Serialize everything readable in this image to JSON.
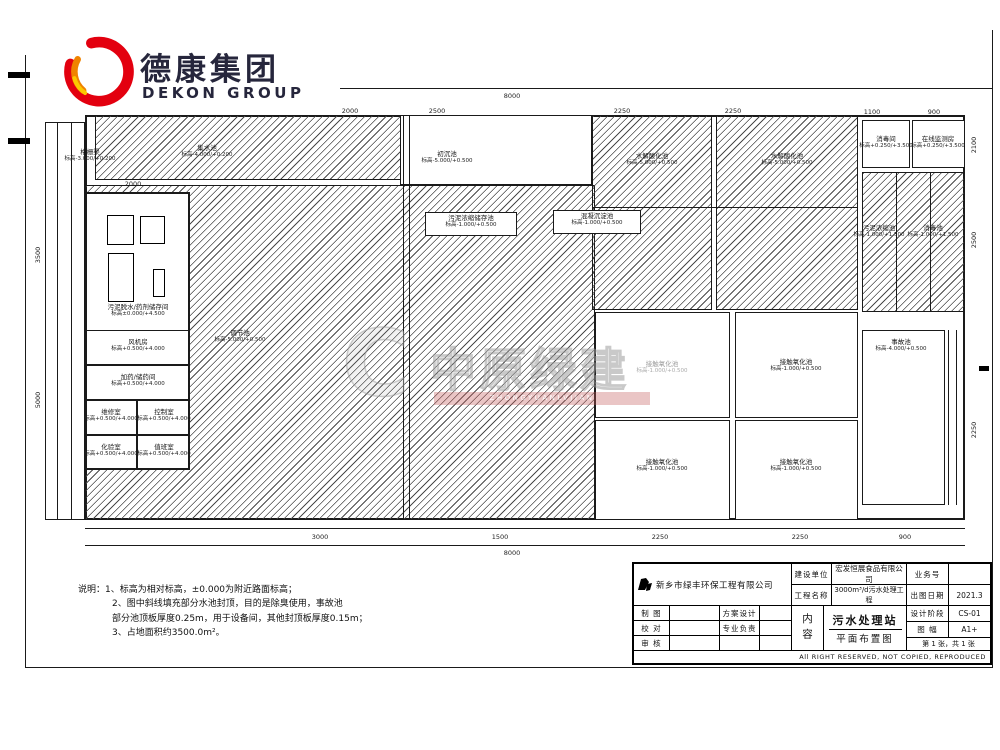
{
  "brand": {
    "logo_cn": "德康集团",
    "logo_en": "DEKON GROUP"
  },
  "watermark": {
    "mark": "C",
    "text": "中原绿建",
    "sub": "ZHONGYUANLVJIAN"
  },
  "notes": {
    "lines": [
      {
        "t": "说明：1、标高为相对标高，±0.000为附近路面标高；",
        "ind": 0
      },
      {
        "t": "2、图中斜线填充部分水池封顶，目的是除臭使用，事故池",
        "ind": 34
      },
      {
        "t": "部分池顶板厚度0.25m，用于设备间，其他封顶板厚度0.15m；",
        "ind": 34
      },
      {
        "t": "3、占地面积约3500.0m²。",
        "ind": 34
      }
    ]
  },
  "title_block": {
    "company": "新乡市绿丰环保工程有限公司",
    "jsdw_label": "建设单位",
    "jsdw_value": "宏发恒展食品有限公司",
    "gcmc_label": "工程名称",
    "gcmc_value": "3000m³/d污水处理工程",
    "ywh_label": "业务号",
    "ywh_value": "",
    "ctrq_label": "出图日期",
    "ctrq_value": "2021.3",
    "zt_label": "制 图",
    "fasj_label": "方案设计",
    "jd_label": "校 对",
    "zyfz_label": "专业负责",
    "sh_label": "审 核",
    "nr_label": "内容",
    "content_line1": "污水处理站",
    "content_line2": "平面布置图",
    "sjjd_label": "设计阶段",
    "sjjd_value": "CS-01",
    "tf_label": "图 幅",
    "tf_value": "A1+",
    "sheet": "第 1 张，共 1 张",
    "copyright": "All RIGHT RESERVED, NOT COPIED, REPRODUCED"
  },
  "plan": {
    "boxes": [
      {
        "n": "plant-boundary",
        "x": 85,
        "y": 115,
        "w": 880,
        "h": 405,
        "thick": 2
      },
      {
        "n": "grit-channel-strip",
        "x": 45,
        "y": 122,
        "w": 40,
        "h": 398,
        "fill": "white"
      },
      {
        "n": "tank-collection",
        "x": 95,
        "y": 115,
        "w": 325,
        "h": 65,
        "hatch": true
      },
      {
        "n": "tank-primary-sedimentation",
        "x": 400,
        "y": 115,
        "w": 192,
        "h": 70,
        "fill": "white"
      },
      {
        "n": "tank-equalization",
        "x": 85,
        "y": 185,
        "w": 510,
        "h": 335,
        "hatch": true
      },
      {
        "n": "tank-hydrolysis-1",
        "x": 592,
        "y": 115,
        "w": 120,
        "h": 195,
        "hatch": true
      },
      {
        "n": "tank-hydrolysis-2",
        "x": 716,
        "y": 115,
        "w": 142,
        "h": 195,
        "hatch": true
      },
      {
        "n": "tank-sludge-row",
        "x": 862,
        "y": 172,
        "w": 103,
        "h": 140,
        "hatch": true
      },
      {
        "n": "label-patch-thickener",
        "x": 425,
        "y": 212,
        "w": 92,
        "h": 24,
        "fill": "white"
      },
      {
        "n": "label-patch-coagulation",
        "x": 553,
        "y": 210,
        "w": 88,
        "h": 24,
        "fill": "white"
      },
      {
        "n": "building-outline",
        "x": 85,
        "y": 192,
        "w": 105,
        "h": 278,
        "fill": "white",
        "thick": 2
      },
      {
        "n": "room-blower",
        "x": 85,
        "y": 330,
        "w": 105,
        "h": 35
      },
      {
        "n": "room-dosing",
        "x": 85,
        "y": 365,
        "w": 105,
        "h": 35
      },
      {
        "n": "room-maintenance",
        "x": 85,
        "y": 400,
        "w": 52,
        "h": 35
      },
      {
        "n": "room-control",
        "x": 137,
        "y": 400,
        "w": 53,
        "h": 35
      },
      {
        "n": "room-laboratory",
        "x": 85,
        "y": 435,
        "w": 52,
        "h": 35
      },
      {
        "n": "room-duty",
        "x": 137,
        "y": 435,
        "w": 53,
        "h": 35
      },
      {
        "n": "tank-oxidation-1",
        "x": 595,
        "y": 312,
        "w": 135,
        "h": 106,
        "fill": "white"
      },
      {
        "n": "tank-oxidation-2",
        "x": 735,
        "y": 312,
        "w": 123,
        "h": 106,
        "fill": "white"
      },
      {
        "n": "tank-oxidation-3",
        "x": 595,
        "y": 420,
        "w": 135,
        "h": 100,
        "fill": "white"
      },
      {
        "n": "tank-oxidation-4",
        "x": 735,
        "y": 420,
        "w": 123,
        "h": 100,
        "fill": "white"
      },
      {
        "n": "room-disinfection",
        "x": 862,
        "y": 120,
        "w": 48,
        "h": 48,
        "fill": "white"
      },
      {
        "n": "room-online-monitoring",
        "x": 912,
        "y": 120,
        "w": 53,
        "h": 48,
        "fill": "white"
      },
      {
        "n": "tank-emergency",
        "x": 862,
        "y": 330,
        "w": 83,
        "h": 175,
        "fill": "white"
      }
    ],
    "lines": [
      {
        "n": "sheet-frame-left",
        "x": 25,
        "y": 55,
        "w": 1,
        "h": 612
      },
      {
        "n": "sheet-frame-bottom",
        "x": 25,
        "y": 667,
        "w": 967,
        "h": 1
      },
      {
        "n": "sheet-frame-right",
        "x": 992,
        "y": 30,
        "w": 1,
        "h": 638
      },
      {
        "n": "sheet-frame-top",
        "x": 340,
        "y": 88,
        "w": 652,
        "h": 1
      },
      {
        "n": "channel-wall-a",
        "x": 403,
        "y": 115,
        "w": 1,
        "h": 405
      },
      {
        "n": "channel-wall-b",
        "x": 409,
        "y": 115,
        "w": 1,
        "h": 405
      },
      {
        "n": "strip-wall-a",
        "x": 57,
        "y": 122,
        "w": 1,
        "h": 398
      },
      {
        "n": "strip-wall-b",
        "x": 71,
        "y": 122,
        "w": 1,
        "h": 398
      },
      {
        "n": "sludge-divider-a",
        "x": 896,
        "y": 172,
        "w": 1,
        "h": 140
      },
      {
        "n": "sludge-divider-b",
        "x": 930,
        "y": 172,
        "w": 1,
        "h": 140
      },
      {
        "n": "hydrolysis-divider",
        "x": 592,
        "y": 207,
        "w": 266,
        "h": 1
      },
      {
        "n": "corridor-wall-a",
        "x": 948,
        "y": 330,
        "w": 1,
        "h": 175
      },
      {
        "n": "corridor-wall-b",
        "x": 956,
        "y": 330,
        "w": 1,
        "h": 175
      },
      {
        "n": "dim-chain-lower-1",
        "x": 85,
        "y": 528,
        "w": 880,
        "h": 1
      },
      {
        "n": "dim-chain-lower-2",
        "x": 85,
        "y": 545,
        "w": 880,
        "h": 1
      }
    ],
    "marks": [
      {
        "x": 8,
        "y": 72,
        "w": 22,
        "h": 6
      },
      {
        "x": 8,
        "y": 138,
        "w": 22,
        "h": 6
      },
      {
        "x": 979,
        "y": 366,
        "w": 10,
        "h": 5
      }
    ],
    "equipment": [
      {
        "x": 107,
        "y": 215,
        "w": 25,
        "h": 28
      },
      {
        "x": 140,
        "y": 216,
        "w": 23,
        "h": 26
      },
      {
        "x": 108,
        "y": 253,
        "w": 24,
        "h": 47
      },
      {
        "x": 153,
        "y": 269,
        "w": 10,
        "h": 26
      }
    ],
    "labels": [
      {
        "x": 90,
        "y": 156,
        "name": "格栅渠",
        "elev": "标高-3.000/+0.200"
      },
      {
        "x": 207,
        "y": 152,
        "name": "集水池",
        "elev": "标高-4.000/+0.200"
      },
      {
        "x": 447,
        "y": 158,
        "name": "初沉池",
        "elev": "标高-5.000/+0.500"
      },
      {
        "x": 471,
        "y": 222,
        "name": "污泥浓缩储存池",
        "elev": "标高-1.000/+0.500"
      },
      {
        "x": 597,
        "y": 220,
        "name": "混凝沉淀池",
        "elev": "标高-1.000/+0.500"
      },
      {
        "x": 240,
        "y": 337,
        "name": "调节池",
        "elev": "标高-5.000/+0.500"
      },
      {
        "x": 138,
        "y": 311,
        "name": "污泥脱水/药剂储存间",
        "elev": "标高±0.000/+4.500"
      },
      {
        "x": 138,
        "y": 346,
        "name": "风机房",
        "elev": "标高+0.500/+4.000"
      },
      {
        "x": 138,
        "y": 381,
        "name": "加药/储药间",
        "elev": "标高+0.500/+4.000"
      },
      {
        "x": 111,
        "y": 416,
        "name": "维修室",
        "elev": "标高+0.500/+4.000"
      },
      {
        "x": 164,
        "y": 416,
        "name": "控制室",
        "elev": "标高+0.500/+4.000"
      },
      {
        "x": 111,
        "y": 451,
        "name": "化验室",
        "elev": "标高+0.500/+4.000"
      },
      {
        "x": 164,
        "y": 451,
        "name": "值班室",
        "elev": "标高+0.500/+4.000"
      },
      {
        "x": 652,
        "y": 160,
        "name": "水解酸化池",
        "elev": "标高-5.000/+0.500"
      },
      {
        "x": 787,
        "y": 160,
        "name": "水解酸化池",
        "elev": "标高-5.000/+0.500"
      },
      {
        "x": 662,
        "y": 368,
        "name": "接触氧化池",
        "elev": "标高-1.000/+0.500",
        "muted": true
      },
      {
        "x": 796,
        "y": 366,
        "name": "接触氧化池",
        "elev": "标高-1.000/+0.500"
      },
      {
        "x": 662,
        "y": 466,
        "name": "接触氧化池",
        "elev": "标高-1.000/+0.500"
      },
      {
        "x": 796,
        "y": 466,
        "name": "接触氧化池",
        "elev": "标高-1.000/+0.500"
      },
      {
        "x": 886,
        "y": 143,
        "name": "消毒间",
        "elev": "标高+0.250/+3.500"
      },
      {
        "x": 938,
        "y": 143,
        "name": "在线监测房",
        "elev": "标高+0.250/+3.500"
      },
      {
        "x": 879,
        "y": 232,
        "name": "污泥浓缩池",
        "elev": "标高-1.000/+1.500"
      },
      {
        "x": 933,
        "y": 232,
        "name": "消毒池",
        "elev": "标高-1.000/+1.500"
      },
      {
        "x": 901,
        "y": 346,
        "name": "事故池",
        "elev": "标高-4.000/+0.500"
      }
    ],
    "dims": [
      {
        "x": 512,
        "y": 96,
        "t": "8000"
      },
      {
        "x": 350,
        "y": 111,
        "t": "2000"
      },
      {
        "x": 437,
        "y": 111,
        "t": "2500"
      },
      {
        "x": 622,
        "y": 111,
        "t": "2250"
      },
      {
        "x": 733,
        "y": 111,
        "t": "2250"
      },
      {
        "x": 872,
        "y": 112,
        "t": "1100"
      },
      {
        "x": 934,
        "y": 112,
        "t": "900"
      },
      {
        "x": 133,
        "y": 184,
        "t": "2000"
      },
      {
        "x": 320,
        "y": 537,
        "t": "3000"
      },
      {
        "x": 500,
        "y": 537,
        "t": "1500"
      },
      {
        "x": 660,
        "y": 537,
        "t": "2250"
      },
      {
        "x": 800,
        "y": 537,
        "t": "2250"
      },
      {
        "x": 905,
        "y": 537,
        "t": "900"
      },
      {
        "x": 512,
        "y": 553,
        "t": "8000"
      },
      {
        "x": 38,
        "y": 255,
        "t": "3500",
        "rot": true
      },
      {
        "x": 38,
        "y": 400,
        "t": "5000",
        "rot": true
      },
      {
        "x": 974,
        "y": 145,
        "t": "2100",
        "rot": true
      },
      {
        "x": 974,
        "y": 240,
        "t": "2500",
        "rot": true
      },
      {
        "x": 974,
        "y": 430,
        "t": "2250",
        "rot": true
      }
    ]
  }
}
